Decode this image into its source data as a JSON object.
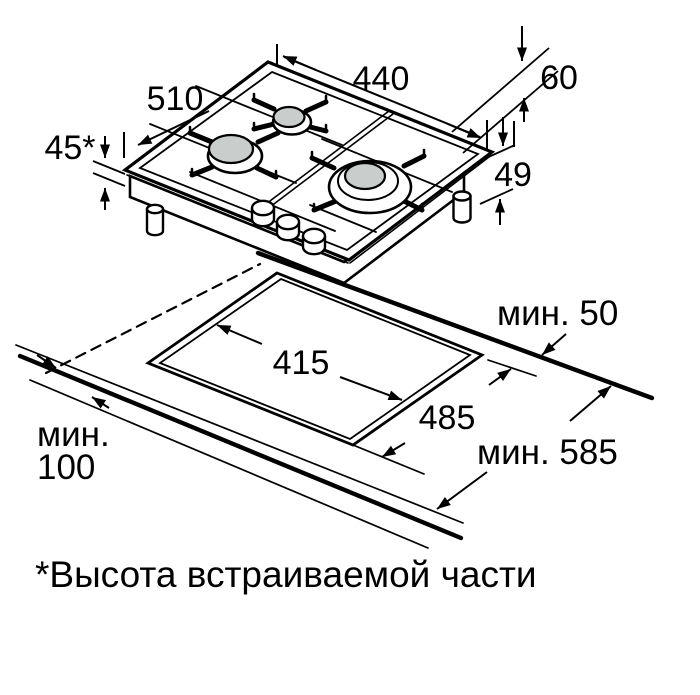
{
  "diagram_type": "built-in gas hob installation dimensions",
  "hob": {
    "width_mm": "440",
    "depth_mm": "510",
    "builtin_height_mm": "45*",
    "height_with_grates_mm": "60",
    "body_below_mm": "49"
  },
  "cutout": {
    "width_mm": "415",
    "depth_mm": "485",
    "rear_min_clearance": "мин. 50",
    "worktop_min_depth": "мин. 585",
    "front_min_word": "мин.",
    "front_min_value": "100"
  },
  "footnote": "*Высота встраиваемой части",
  "colors": {
    "line": "#000000",
    "burner_fill": "#c9cdcb",
    "background": "#ffffff"
  }
}
